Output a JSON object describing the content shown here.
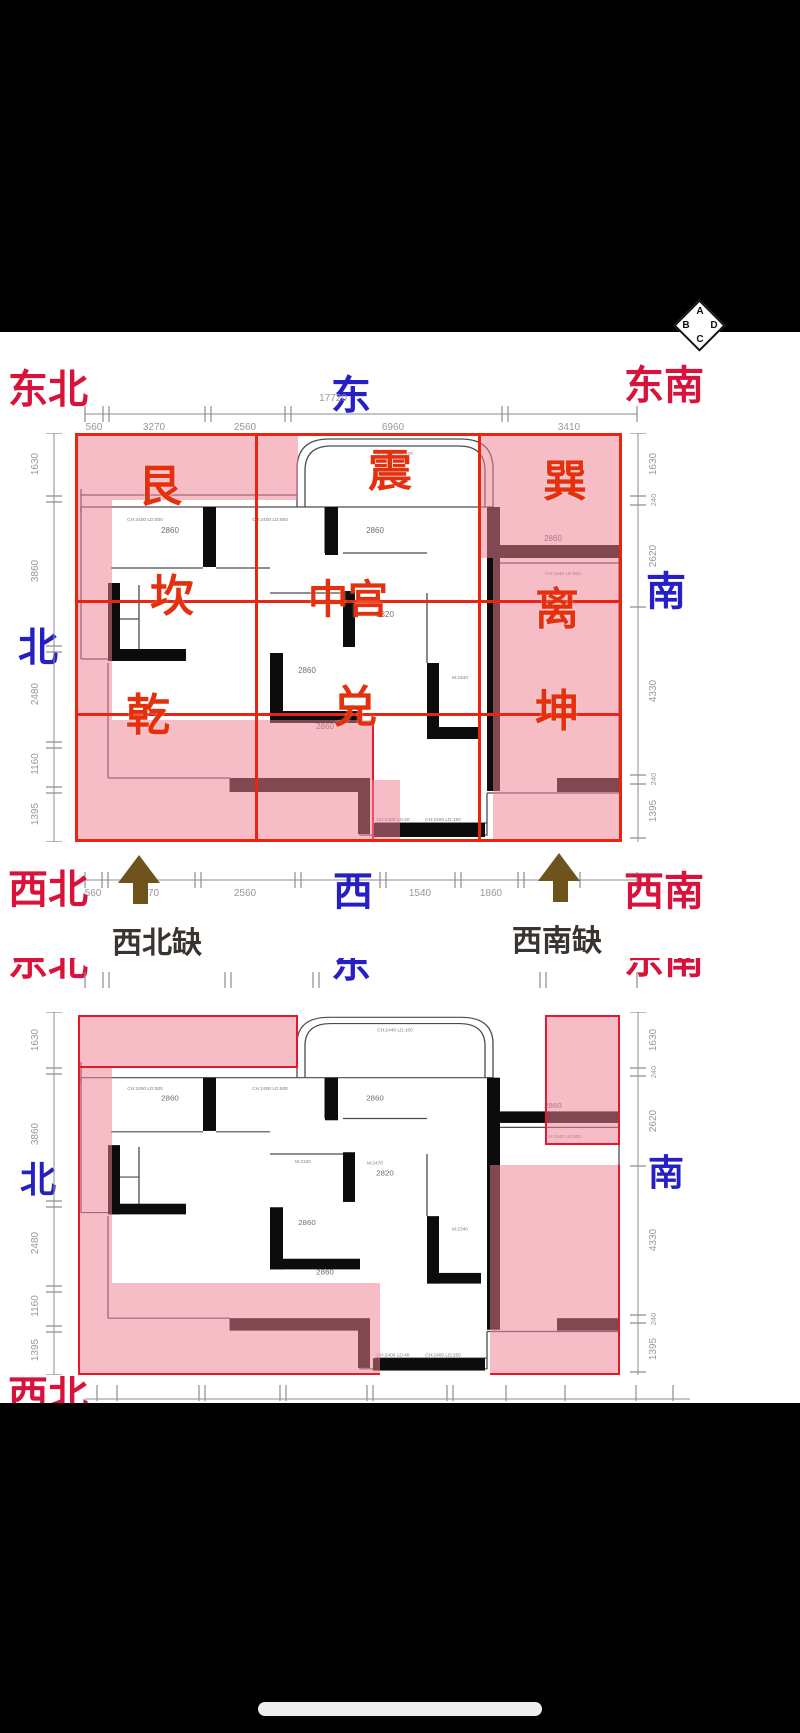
{
  "compass": {
    "top": "A",
    "left": "B",
    "right": "D",
    "bottom": "C"
  },
  "directions": {
    "ne": "东北",
    "e": "东",
    "se": "东南",
    "n": "北",
    "s": "南",
    "nw": "西北",
    "w": "西",
    "sw": "西南"
  },
  "trigrams": {
    "gen": "艮",
    "zhen": "震",
    "xun": "巽",
    "kan": "坎",
    "center": "中宫",
    "li": "离",
    "qian": "乾",
    "dui": "兑",
    "kun": "坤"
  },
  "annotations": {
    "nw_missing": "西北缺",
    "sw_missing": "西南缺"
  },
  "dims": {
    "top_total": "17720",
    "top_segments": [
      "560",
      "3270",
      "2560",
      "6960",
      "3410"
    ],
    "bottom_segments": [
      "560",
      "2470",
      "2560",
      "1540",
      "1860"
    ],
    "left_segments": [
      "1630",
      "3860",
      "2480",
      "1160",
      "1395"
    ],
    "right_segments": [
      "1630",
      "2620",
      "4330",
      "1395"
    ],
    "right_small": "240"
  },
  "floorplan": {
    "room_labels": [
      "2860",
      "2860",
      "2860",
      "2820",
      "2860",
      "2860"
    ],
    "window_labels": [
      "CH:2400 LD:500",
      "CH:2400 LD:500",
      "CH:2440 LD:100",
      "CH:1540 LD:900",
      "CH:2400 LD:40",
      "CH:2400 LD:150"
    ],
    "door_labels": [
      "M:2470",
      "M:2340",
      "M:2340"
    ]
  },
  "colors": {
    "direction_red": "#d8123a",
    "trigram_red": "#e5300e",
    "grid_red": "#ea2410",
    "compass_blue": "#2620c4",
    "missing_pink": "#f0a0ae",
    "arrow_brown": "#6e531d"
  }
}
